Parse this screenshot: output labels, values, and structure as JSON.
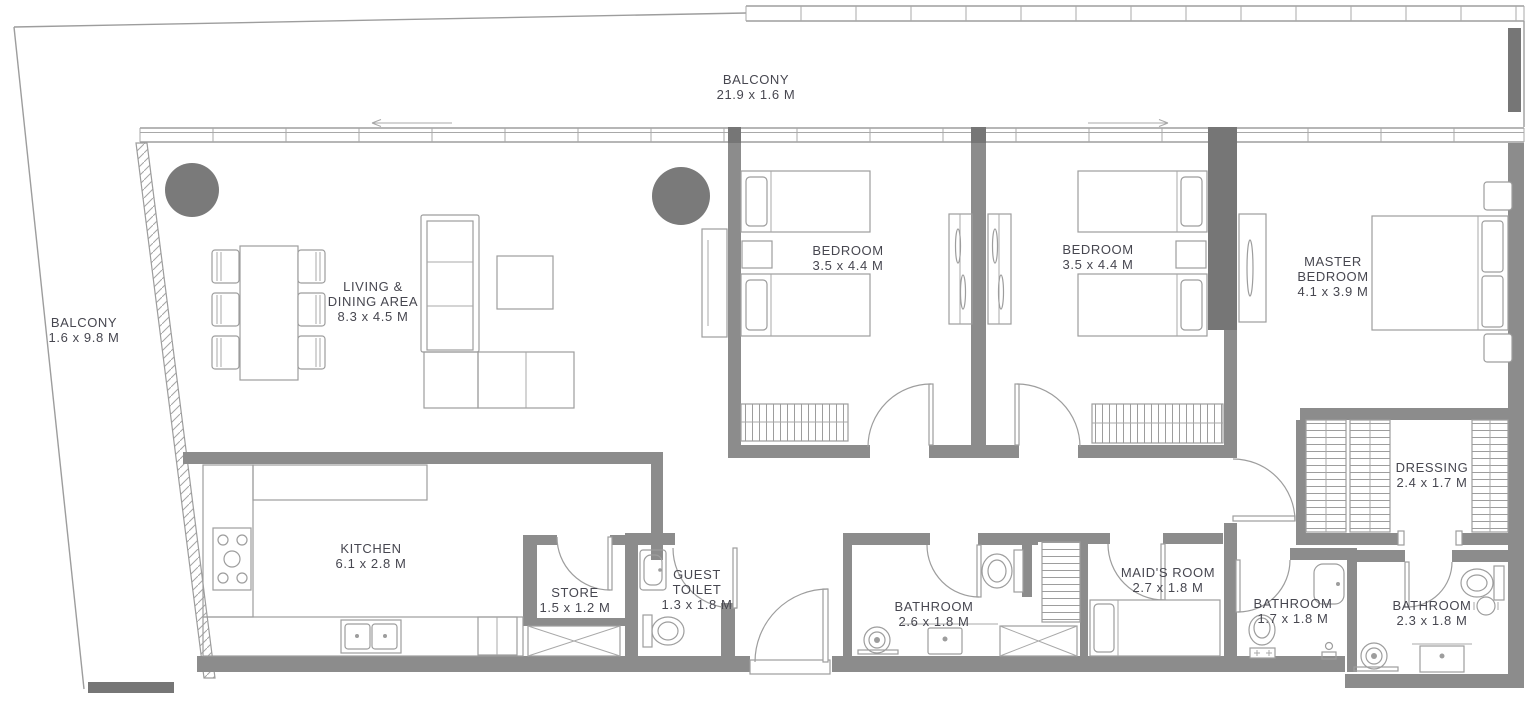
{
  "document": {
    "type": "apartment-floor-plan",
    "dimension_unit": "M"
  },
  "colors": {
    "background": "#ffffff",
    "wall": "#8c8c8c",
    "wall_dark": "#767676",
    "drawing_line": "#9d9d9d",
    "column": "#7a7a7a",
    "label_text": "#474750"
  },
  "rooms": {
    "balcony_top": {
      "name": "BALCONY",
      "dims": "21.9 x 1.6 M"
    },
    "balcony_left": {
      "name": "BALCONY",
      "dims": "1.6 x 9.8 M"
    },
    "living_dining": {
      "name_line1": "LIVING &",
      "name_line2": "DINING AREA",
      "dims": "8.3 x 4.5 M"
    },
    "bedroom_1": {
      "name": "BEDROOM",
      "dims": "3.5 x 4.4 M"
    },
    "bedroom_2": {
      "name": "BEDROOM",
      "dims": "3.5 x 4.4 M"
    },
    "master_bedroom": {
      "name_line1": "MASTER",
      "name_line2": "BEDROOM",
      "dims": "4.1 x 3.9 M"
    },
    "dressing": {
      "name": "DRESSING",
      "dims": "2.4 x 1.7 M"
    },
    "kitchen": {
      "name": "KITCHEN",
      "dims": "6.1 x 2.8 M"
    },
    "store": {
      "name": "STORE",
      "dims": "1.5 x 1.2 M"
    },
    "guest_toilet": {
      "name_line1": "GUEST",
      "name_line2": "TOILET",
      "dims": "1.3 x 1.8 M"
    },
    "bathroom_main": {
      "name": "BATHROOM",
      "dims": "2.6 x 1.8 M"
    },
    "maids_room": {
      "name": "MAID'S ROOM",
      "dims": "2.7 x 1.8 M"
    },
    "bathroom_maid": {
      "name": "BATHROOM",
      "dims": "1.7 x 1.8 M"
    },
    "bathroom_master": {
      "name": "BATHROOM",
      "dims": "2.3 x 1.8 M"
    }
  }
}
